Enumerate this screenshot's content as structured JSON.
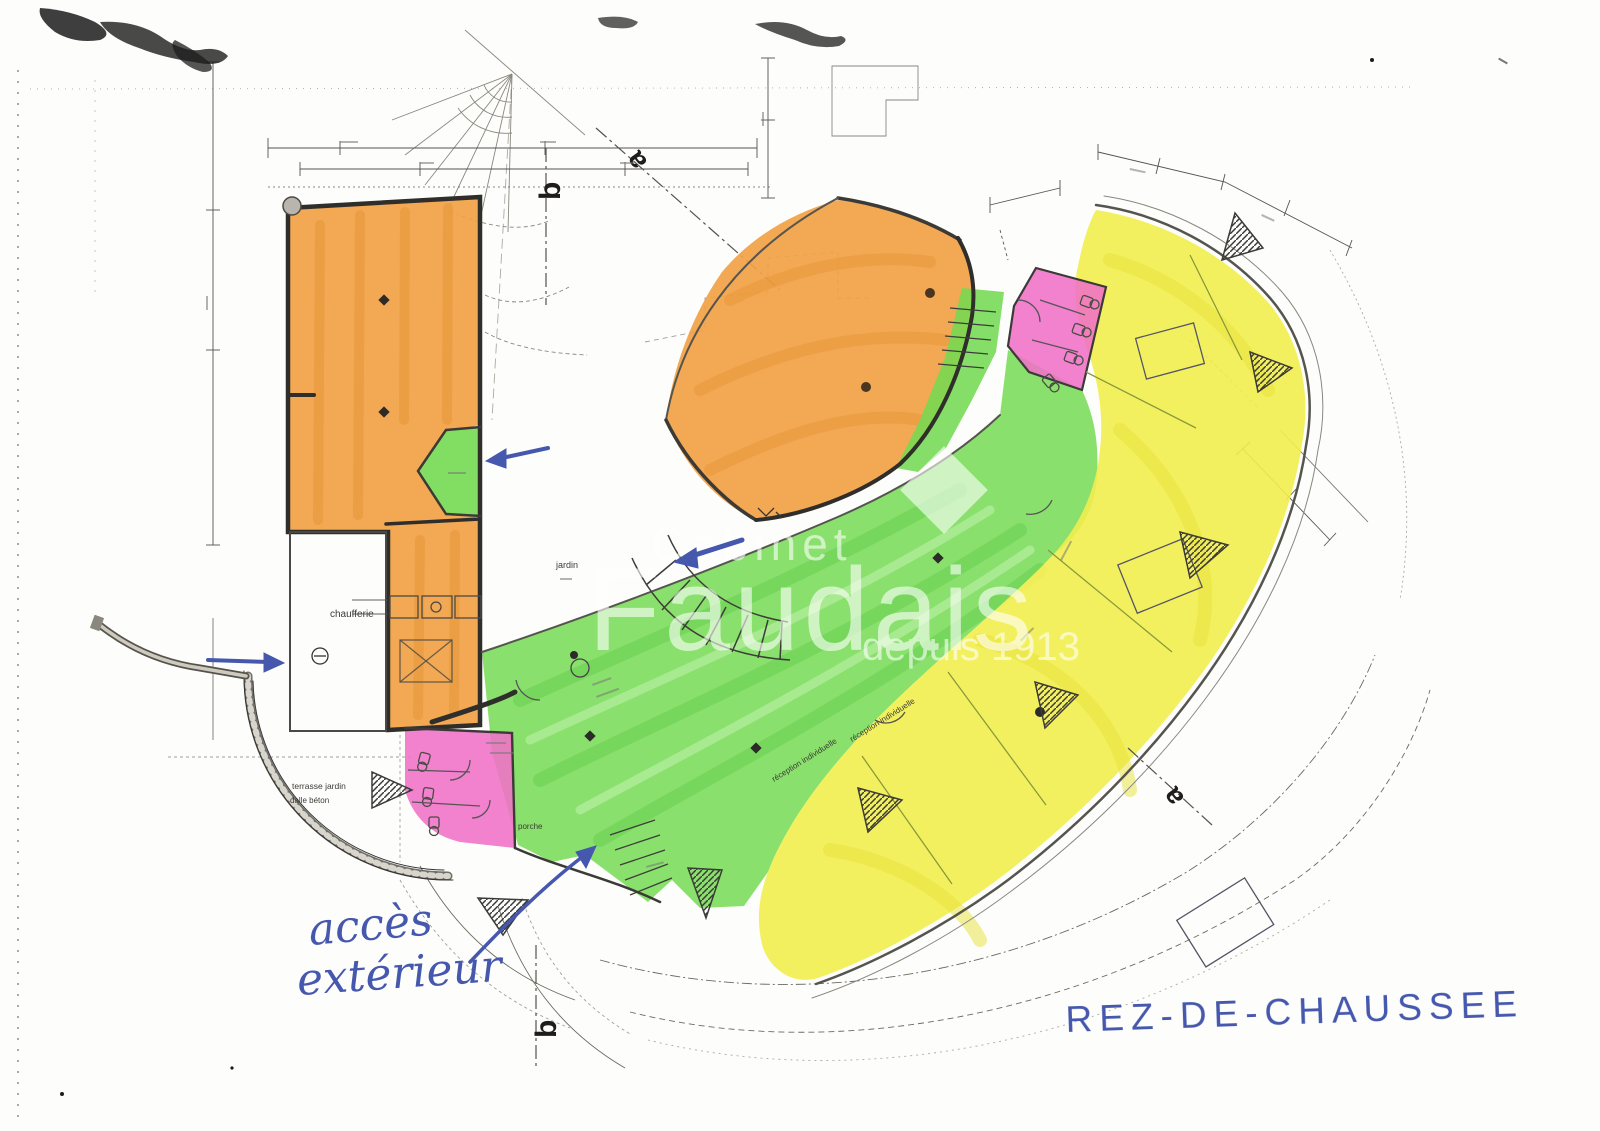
{
  "document": {
    "kind": "scanned architectural floor plan",
    "floor_title": "REZ-DE-CHAUSSEE"
  },
  "annotations": {
    "access_line1": "accès",
    "access_line2": "extérieur",
    "floor_title": "REZ-DE-CHAUSSEE"
  },
  "watermark": {
    "line1": "Cabinet",
    "line2": "Faudais",
    "line3": "depuis 1913"
  },
  "section_markers": {
    "b_top": "b",
    "a_top": "a",
    "b_bottom": "b",
    "a_right": "a"
  },
  "room_labels": {
    "chaufferie": "chaufferie",
    "jardin": "jardin",
    "porche": "porche",
    "terrace_line1": "terrasse jardin",
    "terrace_line2": "dalle béton",
    "reception_1": "réception individuelle",
    "reception_2": "réception individuelle"
  },
  "colors": {
    "highlight_orange": "#f2a144",
    "highlight_green": "#74da52",
    "highlight_yellow": "#f2ee4e",
    "highlight_pink": "#f06fc7",
    "ink_blue": "#4558ae",
    "wall_dark": "#2f2e2b",
    "line_gray": "#6b695f",
    "paper": "#fdfdfb"
  }
}
